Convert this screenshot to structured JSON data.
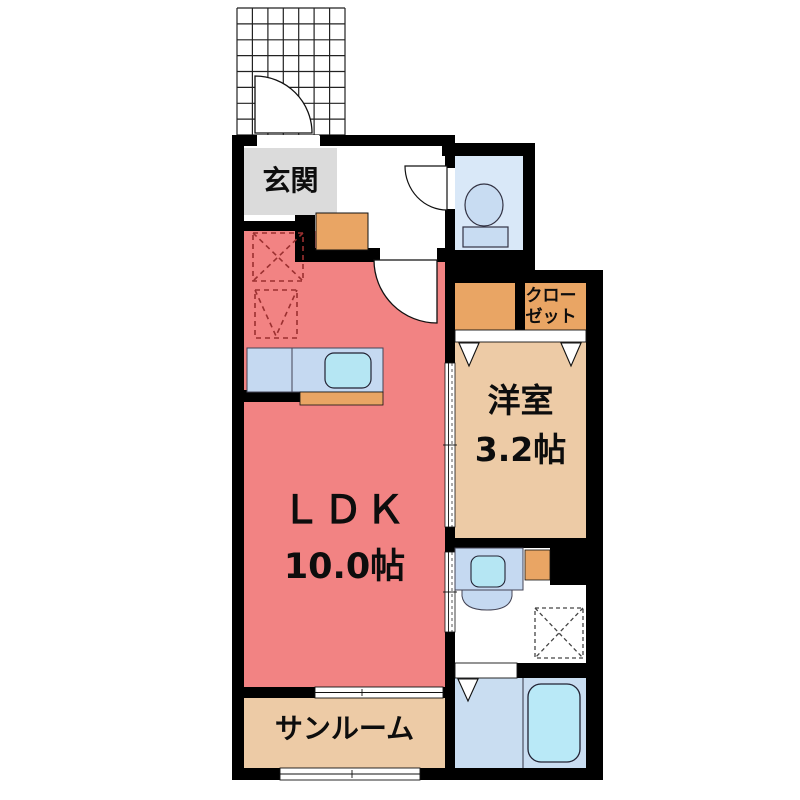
{
  "floorplan": {
    "rooms": {
      "genkan": {
        "label": "玄関"
      },
      "ldk": {
        "name": "ＬＤＫ",
        "size": "10.0帖"
      },
      "western_room": {
        "name": "洋室",
        "size": "3.2帖"
      },
      "closet": {
        "line1": "クロー",
        "line2": "ゼット"
      },
      "sunroom": {
        "label": "サンルーム"
      }
    },
    "colors": {
      "wall": "#000000",
      "ldk": "#F28383",
      "tatami": "#EDCBA6",
      "cabinet": "#E9A564",
      "genkan": "#DBDBDB",
      "toilet_room": "#D9E8F8",
      "fixture": "#C8DCF2",
      "counter": "#C5D9F1",
      "sink": "#B5E6F3",
      "bath": "#C9DDF1",
      "tub": "#B9E9F7",
      "dashed_red": "#9B3030",
      "dashed_dark": "#444444",
      "floor_white": "#FFFFFF"
    }
  }
}
